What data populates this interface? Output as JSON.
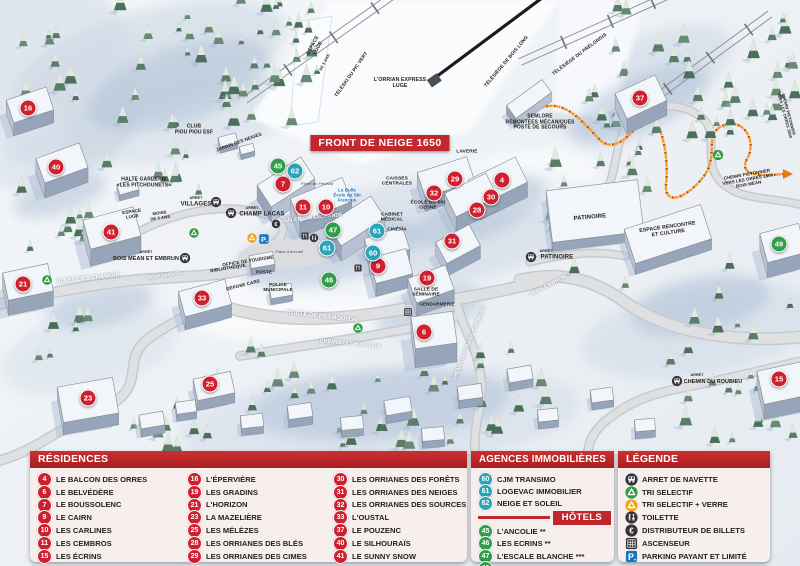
{
  "colors": {
    "red_marker": "#cf2030",
    "green_marker": "#2e9e48",
    "blue_marker": "#2ba3b8",
    "header_red": "#c0262c",
    "banner_red": "#c1272d",
    "parking_blue": "#1b75bc",
    "recycle_green": "#2f9e41",
    "recycle_yellow": "#f0a51e",
    "path_orange": "#f2a51a"
  },
  "map": {
    "banner": "FRONT DE NEIGE 1650",
    "markers": [
      {
        "n": "16",
        "x": 28,
        "y": 108,
        "c": "red"
      },
      {
        "n": "40",
        "x": 56,
        "y": 167,
        "c": "red"
      },
      {
        "n": "41",
        "x": 111,
        "y": 232,
        "c": "red"
      },
      {
        "n": "21",
        "x": 23,
        "y": 284,
        "c": "red"
      },
      {
        "n": "33",
        "x": 202,
        "y": 298,
        "c": "red"
      },
      {
        "n": "23",
        "x": 88,
        "y": 398,
        "c": "red"
      },
      {
        "n": "25",
        "x": 210,
        "y": 384,
        "c": "red"
      },
      {
        "n": "7",
        "x": 283,
        "y": 184,
        "c": "red"
      },
      {
        "n": "11",
        "x": 303,
        "y": 207,
        "c": "red"
      },
      {
        "n": "10",
        "x": 326,
        "y": 207,
        "c": "red"
      },
      {
        "n": "9",
        "x": 378,
        "y": 266,
        "c": "red"
      },
      {
        "n": "29",
        "x": 455,
        "y": 179,
        "c": "red"
      },
      {
        "n": "4",
        "x": 502,
        "y": 180,
        "c": "red"
      },
      {
        "n": "32",
        "x": 434,
        "y": 193,
        "c": "red"
      },
      {
        "n": "30",
        "x": 491,
        "y": 197,
        "c": "red"
      },
      {
        "n": "28",
        "x": 477,
        "y": 210,
        "c": "red"
      },
      {
        "n": "31",
        "x": 452,
        "y": 241,
        "c": "red"
      },
      {
        "n": "19",
        "x": 427,
        "y": 278,
        "c": "red"
      },
      {
        "n": "6",
        "x": 424,
        "y": 332,
        "c": "red"
      },
      {
        "n": "37",
        "x": 640,
        "y": 98,
        "c": "red"
      },
      {
        "n": "15",
        "x": 779,
        "y": 379,
        "c": "red"
      },
      {
        "n": "45",
        "x": 278,
        "y": 166,
        "c": "green"
      },
      {
        "n": "47",
        "x": 333,
        "y": 230,
        "c": "green"
      },
      {
        "n": "46",
        "x": 329,
        "y": 280,
        "c": "green"
      },
      {
        "n": "49",
        "x": 779,
        "y": 244,
        "c": "green"
      },
      {
        "n": "62",
        "x": 295,
        "y": 171,
        "c": "blue"
      },
      {
        "n": "61",
        "x": 327,
        "y": 248,
        "c": "blue"
      },
      {
        "n": "61",
        "x": 377,
        "y": 231,
        "c": "blue"
      },
      {
        "n": "60",
        "x": 373,
        "y": 253,
        "c": "blue"
      }
    ],
    "labels": [
      {
        "lines": [
          "ESPACE",
          "LUGE"
        ],
        "x": 316,
        "y": 47,
        "r": -62,
        "fs": 5,
        "cls": "dark"
      },
      {
        "lines": [
          "+ DE 5 ANS"
        ],
        "x": 324,
        "y": 64,
        "r": -62,
        "fs": 3.8,
        "cls": "dark"
      },
      {
        "lines": [
          "TÉLÉSKI DU PIC VERT"
        ],
        "x": 352,
        "y": 75,
        "r": -55,
        "fs": 4.8,
        "cls": "dark"
      },
      {
        "lines": [
          "L'ORRIAN EXPRESS",
          "LUGE"
        ],
        "x": 400,
        "y": 84,
        "r": 0,
        "fs": 5.2,
        "cls": "dark"
      },
      {
        "lines": [
          "TÉLÉSIÈGE DE BOIS LONG"
        ],
        "x": 507,
        "y": 62,
        "r": -50,
        "fs": 4.8,
        "cls": "dark"
      },
      {
        "lines": [
          "TÉLÉSIÈGE DU PRÉLONGIS"
        ],
        "x": 580,
        "y": 55,
        "r": -37,
        "fs": 4.8,
        "cls": "dark"
      },
      {
        "lines": [
          "SEMLORE",
          "REMONTÉES MÉCANIQUES",
          "POSTE DE SECOURS"
        ],
        "x": 540,
        "y": 123,
        "r": 0,
        "fs": 5,
        "cls": "dark"
      },
      {
        "lines": [
          "CLUB",
          "PIOU PIOU ESF"
        ],
        "x": 194,
        "y": 130,
        "r": 0,
        "fs": 5,
        "cls": "dark"
      },
      {
        "lines": [
          "JARDIN DES NEIGES"
        ],
        "x": 239,
        "y": 142,
        "r": -20,
        "fs": 4.6,
        "cls": "dark"
      },
      {
        "lines": [
          "HALTE GARDERIE",
          "«LES PITCHOUNETS»"
        ],
        "x": 144,
        "y": 183,
        "r": 0,
        "fs": 5,
        "cls": "dark"
      },
      {
        "lines": [
          "ESPACE",
          "LUGE"
        ],
        "x": 132,
        "y": 214,
        "r": -8,
        "fs": 4.6,
        "cls": "dark"
      },
      {
        "lines": [
          "MOINS",
          "DE 5 ANS"
        ],
        "x": 160,
        "y": 216,
        "r": -8,
        "fs": 4.2,
        "cls": "dark"
      },
      {
        "lines": [
          "ARRÊT"
        ],
        "x": 196,
        "y": 198,
        "r": 0,
        "fs": 3.6,
        "cls": "dark"
      },
      {
        "lines": [
          "VILLAGES"
        ],
        "x": 196,
        "y": 205,
        "r": 0,
        "fs": 6,
        "cls": "dark"
      },
      {
        "lines": [
          "ARRÊT"
        ],
        "x": 252,
        "y": 208,
        "r": 0,
        "fs": 3.6,
        "cls": "dark"
      },
      {
        "lines": [
          "CHAMP LACAS"
        ],
        "x": 262,
        "y": 215,
        "r": 0,
        "fs": 6,
        "cls": "dark"
      },
      {
        "lines": [
          "La Bulle",
          "École du Ski",
          "Français"
        ],
        "x": 347,
        "y": 196,
        "r": 0,
        "fs": 4.4,
        "cls": "blue"
      },
      {
        "lines": [
          "Place du Festival"
        ],
        "x": 317,
        "y": 184,
        "r": 0,
        "fs": 4,
        "cls": "italic"
      },
      {
        "lines": [
          "GALERIE MARCHANDE"
        ],
        "x": 313,
        "y": 219,
        "r": -6,
        "fs": 5.2,
        "cls": "white"
      },
      {
        "lines": [
          "CAISSES",
          "CENTRALES"
        ],
        "x": 397,
        "y": 182,
        "r": 0,
        "fs": 4.8,
        "cls": "dark"
      },
      {
        "lines": [
          "CABINET",
          "MÉDICAL"
        ],
        "x": 392,
        "y": 218,
        "r": 0,
        "fs": 4.8,
        "cls": "dark"
      },
      {
        "lines": [
          "CINÉMA"
        ],
        "x": 397,
        "y": 230,
        "r": 0,
        "fs": 4.8,
        "cls": "dark"
      },
      {
        "lines": [
          "ÉCOLE DE SKI",
          "OZONE"
        ],
        "x": 428,
        "y": 206,
        "r": 0,
        "fs": 4.8,
        "cls": "dark"
      },
      {
        "lines": [
          "LAVERIE"
        ],
        "x": 467,
        "y": 152,
        "r": 0,
        "fs": 4.8,
        "cls": "dark"
      },
      {
        "lines": [
          "PATINOIRE"
        ],
        "x": 590,
        "y": 218,
        "r": -5,
        "fs": 6,
        "cls": "dark"
      },
      {
        "lines": [
          "ESPACE RENCONTRE",
          "ET CULTURE"
        ],
        "x": 668,
        "y": 231,
        "r": -8,
        "fs": 5.2,
        "cls": "dark"
      },
      {
        "lines": [
          "ARRÊT"
        ],
        "x": 546,
        "y": 251,
        "r": 0,
        "fs": 3.6,
        "cls": "dark"
      },
      {
        "lines": [
          "PATINOIRE"
        ],
        "x": 557,
        "y": 258,
        "r": 0,
        "fs": 6,
        "cls": "dark"
      },
      {
        "lines": [
          "OFFICE DE TOURISME"
        ],
        "x": 248,
        "y": 261,
        "r": -9,
        "fs": 4.6,
        "cls": "dark"
      },
      {
        "lines": [
          "BIBLIOTHÈQUE"
        ],
        "x": 228,
        "y": 268,
        "r": -9,
        "fs": 4.6,
        "cls": "dark"
      },
      {
        "lines": [
          "POSTE"
        ],
        "x": 264,
        "y": 272,
        "r": 0,
        "fs": 4.6,
        "cls": "dark"
      },
      {
        "lines": [
          "DÉPOSE CARS"
        ],
        "x": 243,
        "y": 285,
        "r": -14,
        "fs": 4.6,
        "cls": "dark"
      },
      {
        "lines": [
          "POLICE",
          "MUNICIPALE"
        ],
        "x": 278,
        "y": 287,
        "r": 0,
        "fs": 4.6,
        "cls": "dark"
      },
      {
        "lines": [
          "Place d'accueil"
        ],
        "x": 289,
        "y": 252,
        "r": 0,
        "fs": 4,
        "cls": "italic"
      },
      {
        "lines": [
          "SALLE DE",
          "SÉMINAIRE"
        ],
        "x": 426,
        "y": 293,
        "r": 0,
        "fs": 4.8,
        "cls": "dark"
      },
      {
        "lines": [
          "GENDARMERIE"
        ],
        "x": 437,
        "y": 304,
        "r": 0,
        "fs": 4.6,
        "cls": "dark"
      },
      {
        "lines": [
          "ARRÊT"
        ],
        "x": 146,
        "y": 252,
        "r": 0,
        "fs": 3.6,
        "cls": "dark"
      },
      {
        "lines": [
          "BOIS MÉAN ET EMBRUN"
        ],
        "x": 146,
        "y": 259,
        "r": 0,
        "fs": 5.4,
        "cls": "dark"
      },
      {
        "lines": [
          "ALLÉE DES CHAMOIS"
        ],
        "x": 88,
        "y": 279,
        "r": -6,
        "fs": 5.8,
        "cls": "white"
      },
      {
        "lines": [
          "PONT SKIEURS"
        ],
        "x": 165,
        "y": 276,
        "r": -10,
        "fs": 4.4,
        "cls": "white"
      },
      {
        "lines": [
          "ROUTE DE PRAMOUTON"
        ],
        "x": 322,
        "y": 317,
        "r": 7,
        "fs": 5.8,
        "cls": "white"
      },
      {
        "lines": [
          "CHEMIN DU MOUFLON"
        ],
        "x": 350,
        "y": 344,
        "r": 5,
        "fs": 5.4,
        "cls": "white"
      },
      {
        "lines": [
          "CHEMIN DU GRAND CORBEAU"
        ],
        "x": 470,
        "y": 344,
        "r": -68,
        "fs": 5.2,
        "cls": "white"
      },
      {
        "lines": [
          "VERS EMBRUN"
        ],
        "x": 548,
        "y": 286,
        "r": -27,
        "fs": 5.4,
        "cls": "white"
      },
      {
        "lines": [
          "ARRÊT"
        ],
        "x": 697,
        "y": 375,
        "r": 0,
        "fs": 3.6,
        "cls": "dark"
      },
      {
        "lines": [
          "CHEMIN DU ROUBIEU"
        ],
        "x": 713,
        "y": 382,
        "r": 0,
        "fs": 5.4,
        "cls": "dark"
      },
      {
        "lines": [
          "CHEMIN PIETONNIER",
          "VERS LES ORRES 1800",
          "BOIS MÉAN"
        ],
        "x": 748,
        "y": 180,
        "r": -10,
        "fs": 4.4,
        "cls": "dark"
      },
      {
        "lines": [
          "CHEMIN PIETONNIER",
          "VERS LES ORRES 1800"
        ],
        "x": 786,
        "y": 115,
        "r": 75,
        "fs": 4,
        "cls": "dark"
      }
    ],
    "icons": [
      {
        "type": "bus",
        "x": 216,
        "y": 202,
        "s": 11
      },
      {
        "type": "bus",
        "x": 231,
        "y": 213,
        "s": 11
      },
      {
        "type": "bus",
        "x": 185,
        "y": 258,
        "s": 11
      },
      {
        "type": "bus",
        "x": 531,
        "y": 257,
        "s": 11
      },
      {
        "type": "bus",
        "x": 677,
        "y": 381,
        "s": 11
      },
      {
        "type": "recycle-green",
        "x": 194,
        "y": 233,
        "s": 10
      },
      {
        "type": "recycle-green",
        "x": 47,
        "y": 280,
        "s": 10
      },
      {
        "type": "recycle-green",
        "x": 358,
        "y": 328,
        "s": 10
      },
      {
        "type": "recycle-green",
        "x": 718,
        "y": 155,
        "s": 11
      },
      {
        "type": "recycle-yellow",
        "x": 252,
        "y": 238,
        "s": 10
      },
      {
        "type": "parking",
        "x": 264,
        "y": 239,
        "s": 11
      },
      {
        "type": "euro",
        "x": 276,
        "y": 224,
        "s": 9
      },
      {
        "type": "toilet",
        "x": 314,
        "y": 238,
        "s": 9
      },
      {
        "type": "resto",
        "x": 305,
        "y": 236,
        "s": 9
      },
      {
        "type": "resto",
        "x": 358,
        "y": 268,
        "s": 9
      },
      {
        "type": "elevator",
        "x": 408,
        "y": 312,
        "s": 9
      }
    ]
  },
  "legend": {
    "residences": {
      "title": "RÉSIDENCES",
      "items": [
        {
          "n": "4",
          "label": "LE BALCON DES ORRES"
        },
        {
          "n": "6",
          "label": "LE BELVÉDÈRE"
        },
        {
          "n": "7",
          "label": "LE BOUSSOLENC"
        },
        {
          "n": "9",
          "label": "LE CAIRN"
        },
        {
          "n": "10",
          "label": "LES CARLINES"
        },
        {
          "n": "11",
          "label": "LES CEMBROS"
        },
        {
          "n": "15",
          "label": "LES ÉCRINS"
        },
        {
          "n": "16",
          "label": "L'ÉPERVIÈRE"
        },
        {
          "n": "19",
          "label": "LES GRADINS"
        },
        {
          "n": "21",
          "label": "L'HORIZON"
        },
        {
          "n": "23",
          "label": "LA MAZELIÈRE"
        },
        {
          "n": "25",
          "label": "LES MÉLÈZES"
        },
        {
          "n": "28",
          "label": "LES ORRIANES DES BLÉS"
        },
        {
          "n": "29",
          "label": "LES ORRIANES DES CIMES"
        },
        {
          "n": "30",
          "label": "LES ORRIANES DES FORÊTS"
        },
        {
          "n": "31",
          "label": "LES ORRIANES DES NEIGES"
        },
        {
          "n": "32",
          "label": "LES ORRIANES DES SOURCES"
        },
        {
          "n": "33",
          "label": "L'OUSTAL"
        },
        {
          "n": "37",
          "label": "LE POUZENC"
        },
        {
          "n": "40",
          "label": "LE SILHOURAÏS"
        },
        {
          "n": "41",
          "label": "LE SUNNY SNOW"
        }
      ]
    },
    "agences": {
      "title": "AGENCES IMMOBILIÈRES",
      "items": [
        {
          "n": "60",
          "label": "CJM TRANSIMO"
        },
        {
          "n": "61",
          "label": "LOGEVAC IMMOBILIER"
        },
        {
          "n": "62",
          "label": "NEIGE ET SOLEIL"
        }
      ]
    },
    "hotels": {
      "title": "HÔTELS",
      "items": [
        {
          "n": "45",
          "label": "L'ANCOLIE **"
        },
        {
          "n": "46",
          "label": "LES ECRINS **"
        },
        {
          "n": "47",
          "label": "L'ESCALE BLANCHE ***"
        },
        {
          "n": "49",
          "label": "LES TRAPPEURS **"
        }
      ]
    },
    "legende": {
      "title": "LÉGENDE",
      "items": [
        {
          "icon": "bus",
          "label": "ARRET DE NAVETTE"
        },
        {
          "icon": "recycle-green",
          "label": "TRI SELECTIF"
        },
        {
          "icon": "recycle-yellow",
          "label": "TRI SELECTIF + VERRE"
        },
        {
          "icon": "toilet",
          "label": "TOILETTE"
        },
        {
          "icon": "euro",
          "label": "DISTRIBUTEUR DE BILLETS"
        },
        {
          "icon": "elevator",
          "label": "ASCENSEUR"
        },
        {
          "icon": "parking",
          "label": "PARKING PAYANT ET LIMITÉ"
        }
      ]
    }
  }
}
